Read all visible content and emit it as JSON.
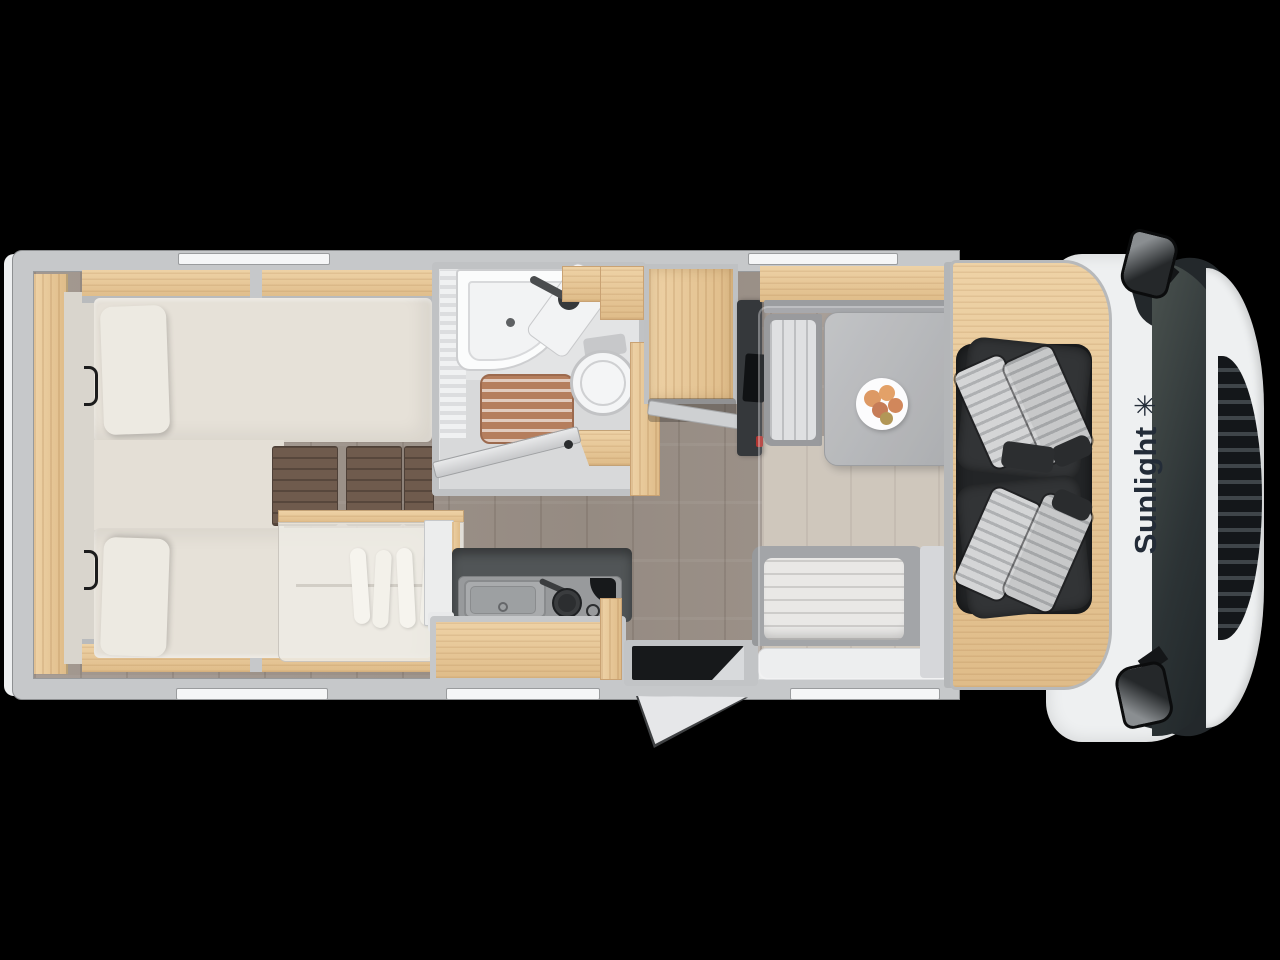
{
  "page": {
    "background_color": "#000000",
    "description": "Top-down floor plan rendering of a Sunlight motorhome with twin rear beds, bathroom, kitchen, dinette and swivelled cab seats"
  },
  "brand": {
    "name": "Sunlight",
    "logo_glyph": "✳",
    "logo_icon": "sun-star-icon",
    "logo_color": "#232c38"
  },
  "palette": {
    "wall": "#c6c8ca",
    "wall_line": "#97999b",
    "wood_light": "#eed2a6",
    "wood_mid": "#dfbc89",
    "teak": "#b57e5d",
    "laminate": "#9d9289",
    "laminate_light": "#c9c0b3",
    "mattress": "#e6e1d8",
    "pillow": "#edeae2",
    "filler": "#e4dfd6",
    "headboard": "#d9d5cd",
    "step_wood": "#6f5b4d",
    "counter": "#515557",
    "counter_inset": "#989a9c",
    "fridge_white": "#eceded",
    "table_gray": "#abadaf",
    "bench_gray": "#97999b",
    "cushion_white": "#e7e6e3",
    "seat_dark": "#323436",
    "stripe_light": "#d4d5d6",
    "stripe_dark": "#aeb0b2",
    "glass": "#262d30",
    "cab_white": "#eef0f1",
    "grille": "#14171a",
    "tv_dark": "#35383b",
    "logo": "#232c38",
    "red": "#b03430",
    "window_white": "#f5f6f7",
    "frame_gray": "#c0c2c4"
  }
}
